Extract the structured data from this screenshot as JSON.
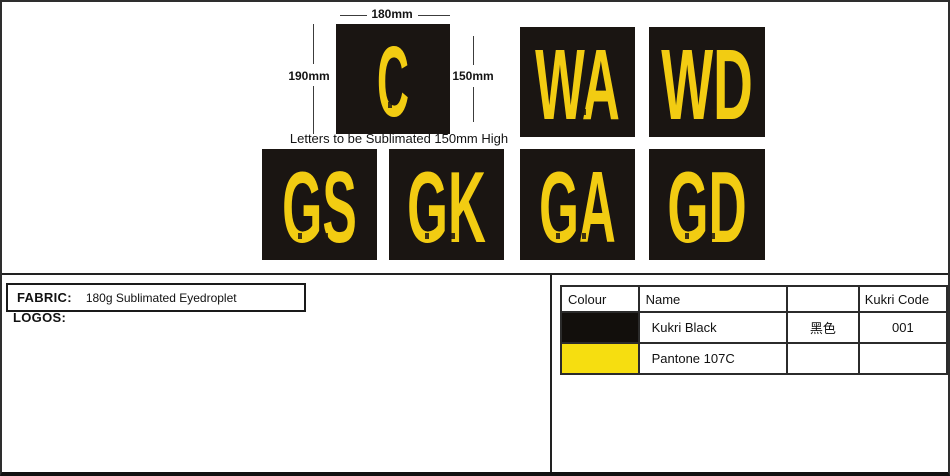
{
  "sheet": {
    "note": "Letters to be Sublimated 150mm High",
    "dimensions": {
      "patch_width": "180mm",
      "patch_height": "190mm",
      "letter_height": "150mm"
    },
    "patches": [
      {
        "label": "C"
      },
      {
        "label": "WA"
      },
      {
        "label": "WD"
      },
      {
        "label": "GS"
      },
      {
        "label": "GK"
      },
      {
        "label": "GA"
      },
      {
        "label": "GD"
      }
    ],
    "fabric": {
      "label": "FABRIC:",
      "value": "180g Sublimated Eyedroplet"
    },
    "logos_label": "LOGOS:",
    "colors": {
      "patch_background": "#1A1512",
      "letter_yellow": "#F2CC12",
      "kukri_black": "#120F0C",
      "pantone_107c": "#F6DE10"
    },
    "color_table": {
      "headers": {
        "colour": "Colour",
        "name": "Name",
        "local_name": "",
        "code": "Kukri Code"
      },
      "rows": [
        {
          "swatch_color": "#120F0C",
          "name": "Kukri Black",
          "local_name": "黑色",
          "code": "001"
        },
        {
          "swatch_color": "#F6DE10",
          "name": "Pantone 107C",
          "local_name": "",
          "code": ""
        }
      ]
    }
  }
}
